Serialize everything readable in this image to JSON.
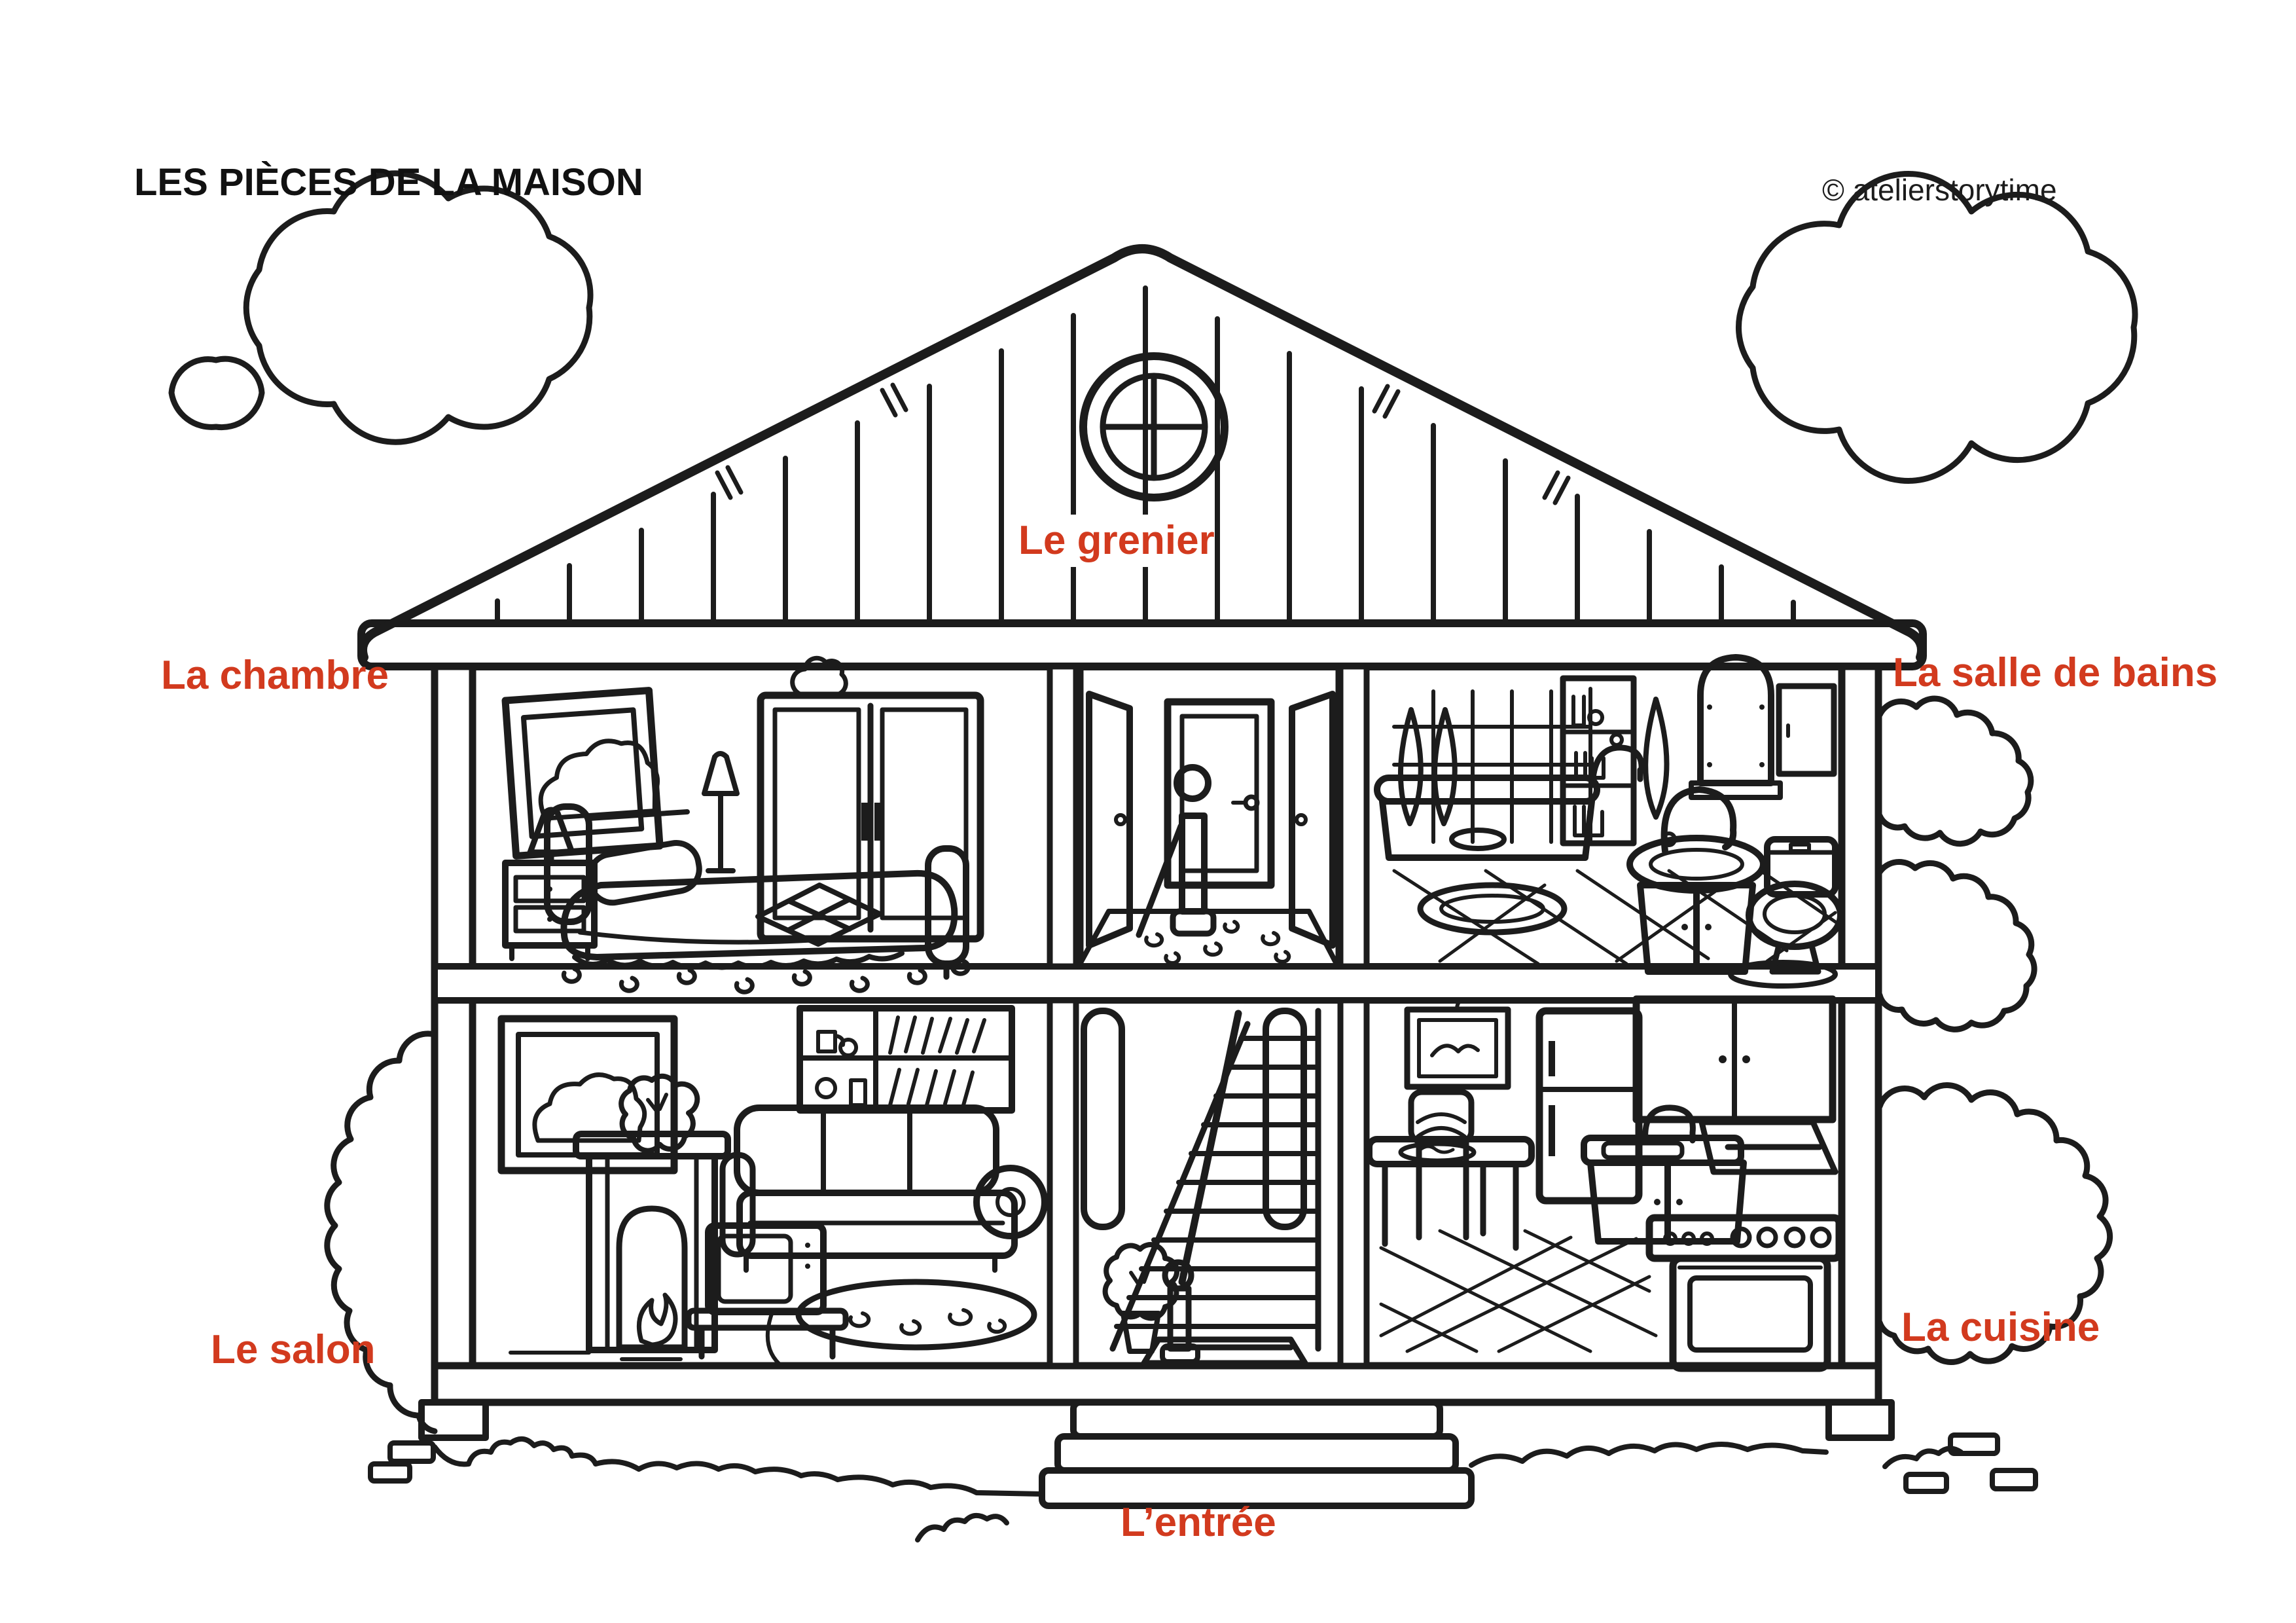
{
  "page": {
    "title": "LES PIÈCES DE LA MAISON",
    "credit": "© atelierstorytime"
  },
  "room_labels": {
    "attic": "Le grenier",
    "bedroom": "La chambre",
    "bathroom": "La salle de bains",
    "living_room": "Le salon",
    "kitchen": "La cuisine",
    "entrance": "L’entrée"
  },
  "colors": {
    "label_red": "#d23a1e",
    "ink": "#1c1c1c",
    "text_black": "#111111",
    "background": "#ffffff"
  }
}
